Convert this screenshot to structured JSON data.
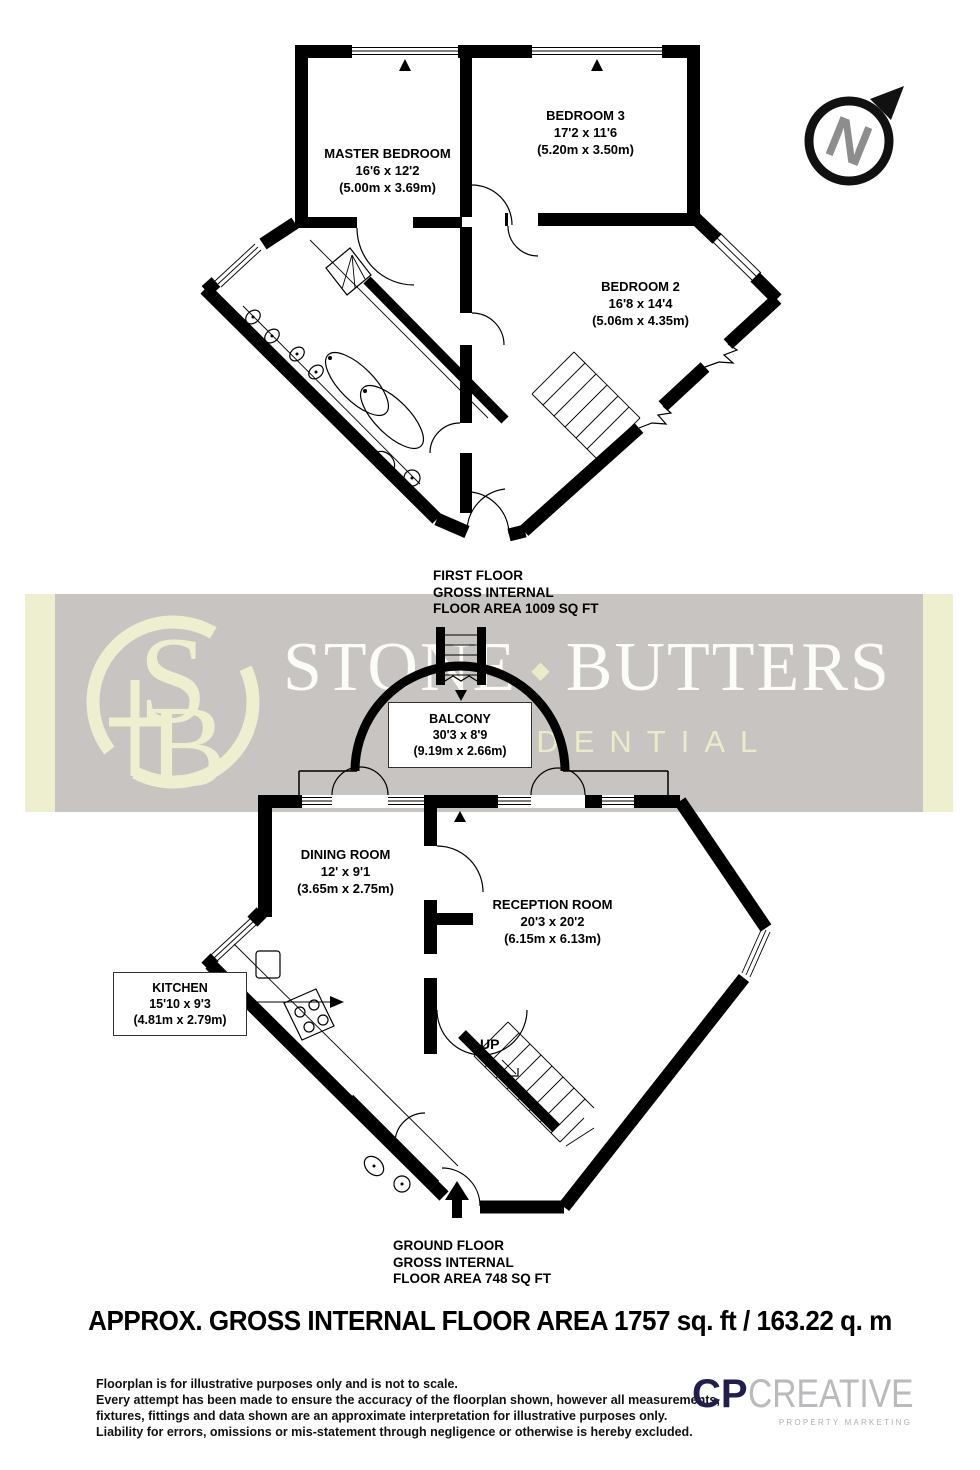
{
  "compass": {
    "letter": "N"
  },
  "first_floor": {
    "rooms": {
      "master_bedroom": {
        "name": "MASTER BEDROOM",
        "dims_ft": "16'6 x 12'2",
        "dims_m": "(5.00m x 3.69m)"
      },
      "bedroom3": {
        "name": "BEDROOM 3",
        "dims_ft": "17'2 x 11'6",
        "dims_m": "(5.20m x 3.50m)"
      },
      "bedroom2": {
        "name": "BEDROOM 2",
        "dims_ft": "16'8 x 14'4",
        "dims_m": "(5.06m x 4.35m)"
      }
    },
    "caption": {
      "l1": "FIRST FLOOR",
      "l2": "GROSS INTERNAL",
      "l3": "FLOOR AREA 1009 SQ FT"
    }
  },
  "ground_floor": {
    "rooms": {
      "balcony": {
        "name": "BALCONY",
        "dims_ft": "30'3 x 8'9",
        "dims_m": "(9.19m x 2.66m)"
      },
      "dining_room": {
        "name": "DINING ROOM",
        "dims_ft": "12' x 9'1",
        "dims_m": "(3.65m x 2.75m)"
      },
      "reception_room": {
        "name": "RECEPTION ROOM",
        "dims_ft": "20'3 x 20'2",
        "dims_m": "(6.15m x 6.13m)"
      },
      "kitchen": {
        "name": "KITCHEN",
        "dims_ft": "15'10 x 9'3",
        "dims_m": "(4.81m x 2.79m)"
      }
    },
    "stairs_label": "UP",
    "caption": {
      "l1": "GROUND FLOOR",
      "l2": "GROSS INTERNAL",
      "l3": "FLOOR AREA 748 SQ FT"
    }
  },
  "watermark": {
    "word1": "STONE",
    "separator": "◆",
    "word2": "BUTTERS",
    "subtitle": "RESIDENTIAL",
    "monogram_s": "S",
    "monogram_b": "B"
  },
  "summary": {
    "text": "APPROX. GROSS INTERNAL FLOOR AREA 1757 sq. ft / 163.22 q. m"
  },
  "disclaimer": {
    "l1": "Floorplan is for illustrative purposes only and is not to scale.",
    "l2": "Every attempt has been made to ensure the accuracy of the floorplan shown, however all measurements,",
    "l3": "fixtures, fittings and data shown are an approximate interpretation for illustrative purposes only.",
    "l4": "Liability for errors, omissions or mis-statement through negligence or otherwise is hereby excluded."
  },
  "credit": {
    "prefix": "CP",
    "name": "CREATIVE",
    "tagline": "PROPERTY MARKETING"
  },
  "colors": {
    "banner_gray": "#c8c4c1",
    "banner_cream": "#edefcf",
    "brand_white": "#fbfbf8",
    "navy": "#211d4e",
    "credit_gray": "#b9babc",
    "compass_n": "#8d8d8d"
  }
}
